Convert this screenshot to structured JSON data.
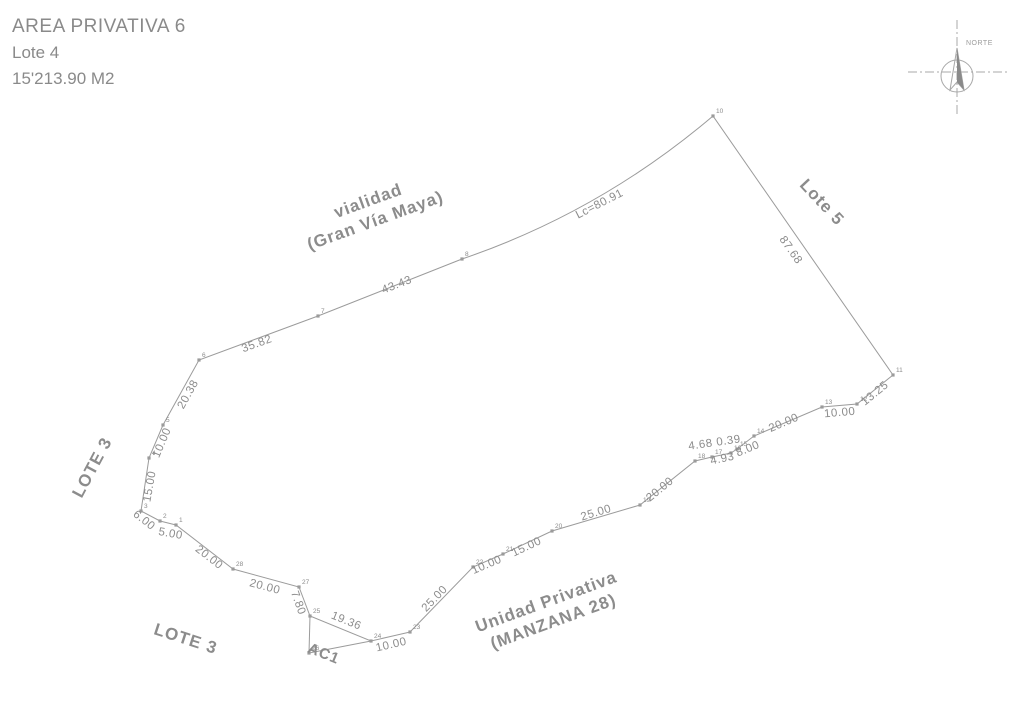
{
  "title_block": {
    "line1": "AREA PRIVATIVA 6",
    "line2": "Lote 4",
    "line3": "15'213.90 M2"
  },
  "compass": {
    "label": "NORTE"
  },
  "colors": {
    "line": "#9b9b9b",
    "text": "#8c8c8c",
    "dark_fill": "#8a8a8a"
  },
  "survey": {
    "boundary_vertices": [
      {
        "id": "1",
        "x": 176,
        "y": 525
      },
      {
        "id": "2",
        "x": 160,
        "y": 521
      },
      {
        "id": "3",
        "x": 141,
        "y": 511
      },
      {
        "id": "4",
        "x": 149,
        "y": 458
      },
      {
        "id": "5",
        "x": 163,
        "y": 425
      },
      {
        "id": "6",
        "x": 199,
        "y": 360
      },
      {
        "id": "7",
        "x": 318,
        "y": 316
      },
      {
        "id": "8",
        "x": 462,
        "y": 259
      },
      {
        "id": "10",
        "x": 713,
        "y": 116
      },
      {
        "id": "11",
        "x": 893,
        "y": 375
      },
      {
        "id": "12",
        "x": 857,
        "y": 404
      },
      {
        "id": "13",
        "x": 822,
        "y": 407
      },
      {
        "id": "14",
        "x": 754,
        "y": 436
      },
      {
        "id": "15",
        "x": 737,
        "y": 449
      },
      {
        "id": "16",
        "x": 731,
        "y": 453
      },
      {
        "id": "17",
        "x": 712,
        "y": 457
      },
      {
        "id": "18",
        "x": 695,
        "y": 461
      },
      {
        "id": "19",
        "x": 640,
        "y": 505
      },
      {
        "id": "20",
        "x": 552,
        "y": 531
      },
      {
        "id": "21",
        "x": 503,
        "y": 554
      },
      {
        "id": "22",
        "x": 473,
        "y": 567
      },
      {
        "id": "23",
        "x": 410,
        "y": 632
      },
      {
        "id": "24",
        "x": 371,
        "y": 641
      },
      {
        "id": "25",
        "x": 310,
        "y": 616
      },
      {
        "id": "27",
        "x": 299,
        "y": 587
      },
      {
        "id": "28",
        "x": 233,
        "y": 569
      }
    ],
    "arc": {
      "after_id": "8",
      "control_x": 600,
      "control_y": 212,
      "label": "Lc=80.91"
    },
    "extra_vertices": [
      {
        "id": "26",
        "x": 309,
        "y": 653
      }
    ],
    "extra_lines": [
      [
        310,
        616,
        309,
        653
      ],
      [
        309,
        653,
        371,
        641
      ]
    ],
    "dim_labels": [
      {
        "text": "5.00",
        "x": 170,
        "y": 537,
        "rot": 10
      },
      {
        "text": "6.00",
        "x": 142,
        "y": 523,
        "rot": 38
      },
      {
        "text": "15.00",
        "x": 153,
        "y": 487,
        "rot": -80
      },
      {
        "text": "10.00",
        "x": 165,
        "y": 444,
        "rot": -67
      },
      {
        "text": "20.38",
        "x": 191,
        "y": 396,
        "rot": -61
      },
      {
        "text": "35.82",
        "x": 258,
        "y": 347,
        "rot": -20
      },
      {
        "text": "43.43",
        "x": 398,
        "y": 288,
        "rot": -21
      },
      {
        "text": "Lc=80.91",
        "x": 601,
        "y": 207,
        "rot": -27
      },
      {
        "text": "87.68",
        "x": 788,
        "y": 252,
        "rot": 55
      },
      {
        "text": "13.25",
        "x": 877,
        "y": 396,
        "rot": -39
      },
      {
        "text": "10.00",
        "x": 840,
        "y": 416,
        "rot": -5
      },
      {
        "text": "20.00",
        "x": 785,
        "y": 426,
        "rot": -23
      },
      {
        "text": "8.00",
        "x": 749,
        "y": 452,
        "rot": -22
      },
      {
        "text": "0.39",
        "x": 729,
        "y": 444,
        "rot": -8
      },
      {
        "text": "4.68",
        "x": 701,
        "y": 448,
        "rot": -8
      },
      {
        "text": "4.93",
        "x": 723,
        "y": 462,
        "rot": -12
      },
      {
        "text": "20.00",
        "x": 662,
        "y": 492,
        "rot": -39
      },
      {
        "text": "25.00",
        "x": 597,
        "y": 516,
        "rot": -17
      },
      {
        "text": "15.00",
        "x": 528,
        "y": 550,
        "rot": -25
      },
      {
        "text": "10.00",
        "x": 488,
        "y": 568,
        "rot": -23
      },
      {
        "text": "25.00",
        "x": 437,
        "y": 601,
        "rot": -46
      },
      {
        "text": "10.00",
        "x": 392,
        "y": 648,
        "rot": -13
      },
      {
        "text": "19.36",
        "x": 345,
        "y": 624,
        "rot": 22
      },
      {
        "text": "7.80",
        "x": 295,
        "y": 604,
        "rot": 70
      },
      {
        "text": "20.00",
        "x": 264,
        "y": 590,
        "rot": 15
      },
      {
        "text": "20.00",
        "x": 207,
        "y": 560,
        "rot": 38
      }
    ],
    "zone_labels": [
      {
        "name": "vialidad-label",
        "lines": [
          "vialidad",
          "(Gran Vía Maya)"
        ],
        "x": 370,
        "y": 206,
        "rot": -20,
        "size": 17,
        "line_height": 21
      },
      {
        "name": "lote5-label",
        "lines": [
          "Lote 5"
        ],
        "x": 818,
        "y": 206,
        "rot": 47,
        "size": 17,
        "line_height": 21
      },
      {
        "name": "lote3-left-label",
        "lines": [
          "LOTE 3"
        ],
        "x": 97,
        "y": 470,
        "rot": -62,
        "size": 17,
        "line_height": 21
      },
      {
        "name": "lote3-bottom-label",
        "lines": [
          "LOTE 3"
        ],
        "x": 184,
        "y": 644,
        "rot": 18,
        "size": 17,
        "line_height": 21
      },
      {
        "name": "ac1-label",
        "lines": [
          "AC1"
        ],
        "x": 322,
        "y": 658,
        "rot": 22,
        "size": 15,
        "line_height": 18
      },
      {
        "name": "unidad-privativa-label",
        "lines": [
          "Unidad Privativa",
          "(MANZANA 28)"
        ],
        "x": 548,
        "y": 607,
        "rot": -20,
        "size": 17,
        "line_height": 21
      }
    ]
  }
}
